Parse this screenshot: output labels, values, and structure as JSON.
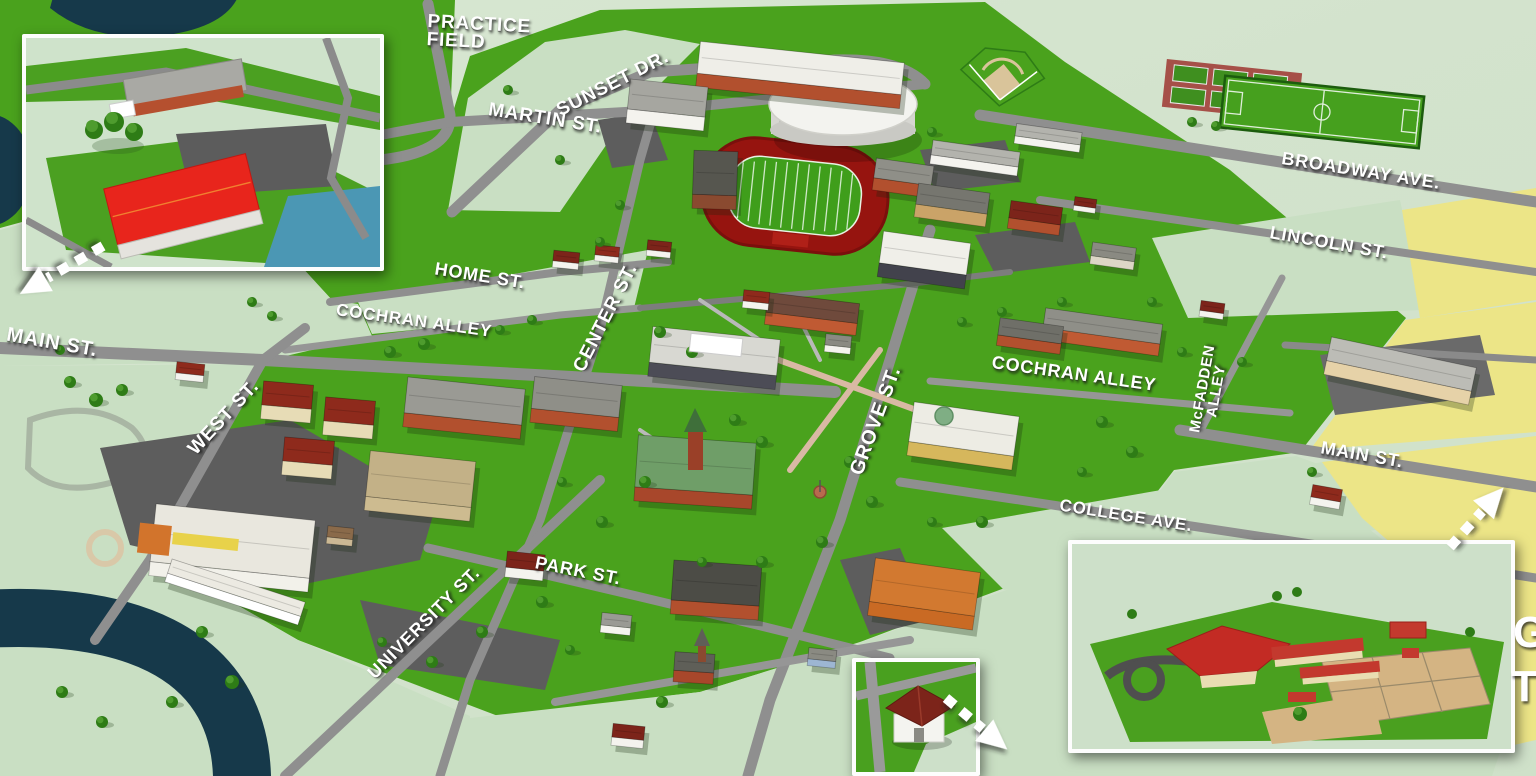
{
  "map": {
    "kind": "3d-illustrated-campus-map",
    "colors": {
      "background": "#d3e4ce",
      "campus_green": "#4aa21d",
      "campus_green_light": "#58aa2e",
      "pale_green": "#c9dfc3",
      "road_gray": "#8f8f8f",
      "parking_gray": "#5d5d5d",
      "river_dark": "#16394a",
      "canal_blue": "#4b97b4",
      "field_yellow": "#ece587",
      "track_red": "#96140f",
      "infield_green": "#3f9e1b",
      "label_white": "#ffffff",
      "inset_highlight_red": "#e8251c"
    }
  },
  "street_labels": [
    {
      "id": "practice-field",
      "text": "PRACTICE\nFIELD",
      "x": 428,
      "y": 13,
      "rot": 3,
      "size": 19,
      "align": "left"
    },
    {
      "id": "sunset-dr",
      "text": "SUNSET DR.",
      "x": 613,
      "y": 84,
      "rot": -27,
      "size": 19,
      "align": "center"
    },
    {
      "id": "martin-st",
      "text": "MARTIN ST.",
      "x": 545,
      "y": 119,
      "rot": 9,
      "size": 19,
      "align": "center"
    },
    {
      "id": "broadway-ave",
      "text": "BROADWAY AVE.",
      "x": 1361,
      "y": 171,
      "rot": 9,
      "size": 18,
      "align": "center"
    },
    {
      "id": "lincoln-st",
      "text": "LINCOLN ST.",
      "x": 1329,
      "y": 243,
      "rot": 10,
      "size": 18,
      "align": "center"
    },
    {
      "id": "home-st",
      "text": "HOME ST.",
      "x": 480,
      "y": 276,
      "rot": 9,
      "size": 18,
      "align": "center"
    },
    {
      "id": "cochran-alley-west",
      "text": "COCHRAN ALLEY",
      "x": 414,
      "y": 321,
      "rot": 8,
      "size": 17,
      "align": "center"
    },
    {
      "id": "main-st-west",
      "text": "MAIN ST.",
      "x": 52,
      "y": 343,
      "rot": 10,
      "size": 20,
      "align": "center"
    },
    {
      "id": "center-st",
      "text": "CENTER ST.",
      "x": 606,
      "y": 318,
      "rot": -63,
      "size": 19,
      "align": "center"
    },
    {
      "id": "west-st",
      "text": "WEST ST.",
      "x": 224,
      "y": 418,
      "rot": -47,
      "size": 19,
      "align": "center"
    },
    {
      "id": "grove-st",
      "text": "GROVE ST.",
      "x": 876,
      "y": 421,
      "rot": -70,
      "size": 20,
      "align": "center"
    },
    {
      "id": "cochran-alley-east",
      "text": "COCHRAN ALLEY",
      "x": 1074,
      "y": 374,
      "rot": 8,
      "size": 18,
      "align": "center"
    },
    {
      "id": "mcfadden-alley",
      "text": "McFADDEN\nALLEY",
      "x": 1210,
      "y": 390,
      "rot": -80,
      "size": 15,
      "align": "center"
    },
    {
      "id": "main-st-east",
      "text": "MAIN ST.",
      "x": 1362,
      "y": 455,
      "rot": 10,
      "size": 18,
      "align": "center"
    },
    {
      "id": "college-ave",
      "text": "COLLEGE AVE.",
      "x": 1126,
      "y": 516,
      "rot": 9,
      "size": 17,
      "align": "center"
    },
    {
      "id": "park-st",
      "text": "PARK ST.",
      "x": 578,
      "y": 571,
      "rot": 11,
      "size": 18,
      "align": "center"
    },
    {
      "id": "university-st",
      "text": "UNIVERSITY ST.",
      "x": 424,
      "y": 623,
      "rot": -45,
      "size": 18,
      "align": "center"
    }
  ],
  "edge_letters": [
    {
      "text": "G",
      "x": 1513,
      "y": 608
    },
    {
      "text": "T",
      "x": 1511,
      "y": 662
    }
  ],
  "arrows": [
    {
      "name": "dashed-arrow-southwest",
      "x": 103,
      "y": 246,
      "rot": 150,
      "len": 96
    },
    {
      "name": "dashed-arrow-northeast",
      "x": 1450,
      "y": 547,
      "rot": -48,
      "len": 80
    },
    {
      "name": "dashed-arrow-southeast",
      "x": 946,
      "y": 698,
      "rot": 40,
      "len": 80
    }
  ],
  "insets": [
    {
      "name": "inset-northwest-facility",
      "desc": "red-roof-athletic-facility-detail"
    },
    {
      "name": "inset-southeast-farm",
      "desc": "farm-complex-detail"
    },
    {
      "name": "inset-south-house",
      "desc": "house-detail"
    }
  ],
  "buildings": [
    {
      "name": "gym-main",
      "x": 800,
      "y": 75,
      "w": 205,
      "h": 46,
      "rot": 6,
      "wall": "#b2502e",
      "roof": "#efeee8"
    },
    {
      "name": "north-dorm-quad",
      "x": 667,
      "y": 105,
      "w": 78,
      "h": 44,
      "rot": 6,
      "wall": "#f4f3ee",
      "roof": "#a6a6a0"
    },
    {
      "name": "chapel-tower-hall",
      "x": 715,
      "y": 180,
      "w": 44,
      "h": 58,
      "rot": 2,
      "wall": "#8a4a30",
      "roof": "#56564f"
    },
    {
      "name": "white-dorm-a",
      "x": 975,
      "y": 158,
      "w": 88,
      "h": 24,
      "rot": 8,
      "wall": "#f4f3ee",
      "roof": "#b3b3ad"
    },
    {
      "name": "white-dorm-b",
      "x": 1048,
      "y": 138,
      "w": 66,
      "h": 20,
      "rot": 8,
      "wall": "#f4f3ee",
      "roof": "#b3b3ad"
    },
    {
      "name": "brick-dorm-a",
      "x": 903,
      "y": 178,
      "w": 58,
      "h": 32,
      "rot": 8,
      "wall": "#b2502e",
      "roof": "#8f8f88"
    },
    {
      "name": "brick-dorm-b",
      "x": 952,
      "y": 205,
      "w": 72,
      "h": 34,
      "rot": 8,
      "wall": "#caa368",
      "roof": "#76766f"
    },
    {
      "name": "dorm-lincoln",
      "x": 1035,
      "y": 218,
      "w": 52,
      "h": 28,
      "rot": 8,
      "wall": "#b2502e",
      "roof": "#7c241a"
    },
    {
      "name": "house-lincoln",
      "x": 1085,
      "y": 205,
      "w": 22,
      "h": 14,
      "rot": 8,
      "wall": "#f4f3ee",
      "roof": "#7c241a"
    },
    {
      "name": "lodge-east",
      "x": 1113,
      "y": 256,
      "w": 44,
      "h": 22,
      "rot": 8,
      "wall": "#ddd6c6",
      "roof": "#8a8a82"
    },
    {
      "name": "stem-hall",
      "x": 924,
      "y": 260,
      "w": 88,
      "h": 46,
      "rot": 8,
      "wall": "#42424c",
      "roof": "#f0efe9"
    },
    {
      "name": "long-dorm-cochran",
      "x": 1102,
      "y": 332,
      "w": 118,
      "h": 32,
      "rot": 8,
      "wall": "#c05a33",
      "roof": "#8f8f88"
    },
    {
      "name": "hall-cochran",
      "x": 1030,
      "y": 336,
      "w": 64,
      "h": 28,
      "rot": 8,
      "wall": "#b2502e",
      "roof": "#6f6f68"
    },
    {
      "name": "house-mcfadden",
      "x": 1212,
      "y": 310,
      "w": 24,
      "h": 16,
      "rot": 8,
      "wall": "#f4f3ee",
      "roof": "#7c241a"
    },
    {
      "name": "tan-dorm-east",
      "x": 1400,
      "y": 371,
      "w": 148,
      "h": 38,
      "rot": 12,
      "wall": "#e6d2a8",
      "roof": "#bcbcb6"
    },
    {
      "name": "library",
      "x": 714,
      "y": 358,
      "w": 128,
      "h": 50,
      "rot": 6,
      "wall": "#4c4c56",
      "roof": "#d8d8d2"
    },
    {
      "name": "dorm-north-of-library",
      "x": 812,
      "y": 314,
      "w": 92,
      "h": 32,
      "rot": 7,
      "wall": "#c05a33",
      "roof": "#6f4a3c"
    },
    {
      "name": "old-main",
      "x": 695,
      "y": 472,
      "w": 118,
      "h": 66,
      "rot": 4,
      "wall": "#a8472b",
      "roof": "#6f9e68"
    },
    {
      "name": "gothic-hall",
      "x": 716,
      "y": 590,
      "w": 88,
      "h": 54,
      "rot": 4,
      "wall": "#b2502e",
      "roof": "#4c4c46"
    },
    {
      "name": "yellow-hall",
      "x": 963,
      "y": 436,
      "w": 106,
      "h": 54,
      "rot": 8,
      "wall": "#d6b75c",
      "roof": "#edece4"
    },
    {
      "name": "orange-barn",
      "x": 924,
      "y": 594,
      "w": 106,
      "h": 58,
      "rot": 8,
      "wall": "#c96a24",
      "roof": "#d27930"
    },
    {
      "name": "tudor-dorm-a",
      "x": 287,
      "y": 402,
      "w": 50,
      "h": 38,
      "rot": 5,
      "wall": "#e7dcb6",
      "roof": "#8e2a1c"
    },
    {
      "name": "tudor-dorm-b",
      "x": 349,
      "y": 418,
      "w": 50,
      "h": 38,
      "rot": 5,
      "wall": "#e7dcb6",
      "roof": "#8e2a1c"
    },
    {
      "name": "tudor-dorm-c",
      "x": 308,
      "y": 458,
      "w": 50,
      "h": 38,
      "rot": 5,
      "wall": "#e7dcb6",
      "roof": "#8e2a1c"
    },
    {
      "name": "mac-hall",
      "x": 464,
      "y": 408,
      "w": 118,
      "h": 50,
      "rot": 6,
      "wall": "#b2502e",
      "roof": "#9a9a94"
    },
    {
      "name": "cupola-hall",
      "x": 576,
      "y": 404,
      "w": 88,
      "h": 46,
      "rot": 6,
      "wall": "#b2502e",
      "roof": "#8f8f88"
    },
    {
      "name": "tan-fieldhouse",
      "x": 420,
      "y": 486,
      "w": 106,
      "h": 60,
      "rot": 6,
      "wall": "#cdbb90",
      "roof": "#c3b187"
    },
    {
      "name": "athletic-center",
      "x": 232,
      "y": 548,
      "w": 160,
      "h": 72,
      "rot": 6,
      "wall": "#f2f1ea",
      "roof": "#e9e7de"
    },
    {
      "name": "rink-hall",
      "x": 235,
      "y": 592,
      "w": 140,
      "h": 24,
      "rot": 18,
      "wall": "#ffffff",
      "roof": "#eceae2"
    },
    {
      "name": "white-barn-park",
      "x": 525,
      "y": 566,
      "w": 38,
      "h": 26,
      "rot": 6,
      "wall": "#f4f3ee",
      "roof": "#7c241a"
    },
    {
      "name": "house-home-1",
      "x": 566,
      "y": 260,
      "w": 26,
      "h": 17,
      "rot": 6,
      "wall": "#f4f3ee",
      "roof": "#7c241a"
    },
    {
      "name": "house-home-2",
      "x": 607,
      "y": 254,
      "w": 24,
      "h": 16,
      "rot": 6,
      "wall": "#f4f3ee",
      "roof": "#8e2a1c"
    },
    {
      "name": "house-home-3",
      "x": 659,
      "y": 249,
      "w": 24,
      "h": 16,
      "rot": 6,
      "wall": "#f4f3ee",
      "roof": "#7c241a"
    },
    {
      "name": "house-center",
      "x": 756,
      "y": 300,
      "w": 26,
      "h": 18,
      "rot": 6,
      "wall": "#f4f3ee",
      "roof": "#8e2a1c"
    },
    {
      "name": "house-grove",
      "x": 838,
      "y": 344,
      "w": 26,
      "h": 18,
      "rot": 6,
      "wall": "#f4f3ee",
      "roof": "#8a8a82"
    },
    {
      "name": "house-west",
      "x": 190,
      "y": 372,
      "w": 28,
      "h": 18,
      "rot": 6,
      "wall": "#f4f3ee",
      "roof": "#8e2a1c"
    },
    {
      "name": "house-university",
      "x": 340,
      "y": 536,
      "w": 26,
      "h": 18,
      "rot": 6,
      "wall": "#cbb894",
      "roof": "#8a6a4a"
    },
    {
      "name": "house-white-south",
      "x": 616,
      "y": 624,
      "w": 30,
      "h": 20,
      "rot": 6,
      "wall": "#f4f3ee",
      "roof": "#9a9a94"
    },
    {
      "name": "church-south",
      "x": 694,
      "y": 668,
      "w": 40,
      "h": 30,
      "rot": 4,
      "wall": "#a8472b",
      "roof": "#5f5f58"
    },
    {
      "name": "house-blue",
      "x": 822,
      "y": 658,
      "w": 28,
      "h": 18,
      "rot": 6,
      "wall": "#9db6d2",
      "roof": "#8a8a82"
    },
    {
      "name": "house-red-south",
      "x": 628,
      "y": 736,
      "w": 32,
      "h": 22,
      "rot": 6,
      "wall": "#f4f3ee",
      "roof": "#7c241a"
    },
    {
      "name": "house-college-east",
      "x": 1326,
      "y": 497,
      "w": 30,
      "h": 20,
      "rot": 10,
      "wall": "#f4f3ee",
      "roof": "#8e2a1c"
    }
  ],
  "trees": [
    [
      70,
      382,
      6
    ],
    [
      96,
      400,
      7
    ],
    [
      122,
      390,
      6
    ],
    [
      60,
      350,
      5
    ],
    [
      252,
      302,
      5
    ],
    [
      272,
      316,
      5
    ],
    [
      390,
      352,
      6
    ],
    [
      424,
      344,
      6
    ],
    [
      500,
      330,
      5
    ],
    [
      532,
      320,
      5
    ],
    [
      620,
      205,
      5
    ],
    [
      600,
      242,
      5
    ],
    [
      660,
      332,
      6
    ],
    [
      692,
      352,
      6
    ],
    [
      735,
      420,
      6
    ],
    [
      762,
      442,
      6
    ],
    [
      645,
      482,
      6
    ],
    [
      602,
      522,
      6
    ],
    [
      562,
      482,
      5
    ],
    [
      850,
      462,
      6
    ],
    [
      872,
      502,
      6
    ],
    [
      822,
      542,
      6
    ],
    [
      762,
      562,
      6
    ],
    [
      702,
      562,
      5
    ],
    [
      962,
      322,
      5
    ],
    [
      1002,
      312,
      5
    ],
    [
      1062,
      302,
      5
    ],
    [
      1152,
      302,
      5
    ],
    [
      1182,
      352,
      5
    ],
    [
      1242,
      362,
      5
    ],
    [
      1102,
      422,
      6
    ],
    [
      1132,
      452,
      6
    ],
    [
      1082,
      472,
      5
    ],
    [
      982,
      522,
      6
    ],
    [
      932,
      522,
      5
    ],
    [
      1312,
      472,
      5
    ],
    [
      542,
      602,
      6
    ],
    [
      482,
      632,
      6
    ],
    [
      432,
      662,
      6
    ],
    [
      382,
      642,
      5
    ],
    [
      662,
      702,
      6
    ],
    [
      570,
      650,
      5
    ],
    [
      202,
      632,
      6
    ],
    [
      232,
      682,
      7
    ],
    [
      172,
      702,
      6
    ],
    [
      62,
      692,
      6
    ],
    [
      102,
      722,
      6
    ],
    [
      1192,
      122,
      5
    ],
    [
      1216,
      126,
      5
    ],
    [
      932,
      132,
      5
    ],
    [
      508,
      90,
      5
    ],
    [
      560,
      160,
      5
    ]
  ]
}
